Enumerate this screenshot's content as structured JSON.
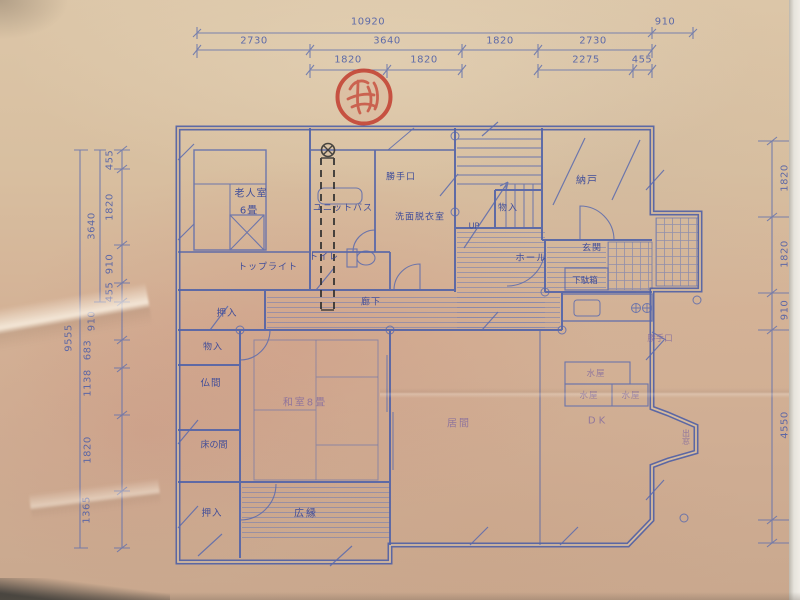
{
  "photo": {
    "description": "Photograph of a hand-drafted Japanese house floor plan (blueprint) with red seal stamp and pencil annotation"
  },
  "colors": {
    "paper": "#d5b59a",
    "ink_blue": "#4f5fa5",
    "label_blue": "#34459a",
    "stamp_red": "#c44536",
    "pencil_black": "#2e2e2e"
  },
  "stamp": {
    "kind": "red-hanko-seal"
  },
  "labels": {
    "roujin": "老人室",
    "roujin_size": "6畳",
    "toplight": "トップライト",
    "unitbath": "ユニットバス",
    "katteguchi_top": "勝手口",
    "senmen": "洗面脱衣室",
    "toilet": "トイレ",
    "monoire_stairs": "物入",
    "up": "UP",
    "nando": "納戸",
    "genkan": "玄関",
    "getabako": "下駄箱",
    "hall": "ホール",
    "rouka": "廊下",
    "oshiire_top": "押入",
    "monoire_left": "物入",
    "butsuma": "仏間",
    "tokonoma": "床の間",
    "oshiire_bottom": "押入",
    "washitsu": "和室8畳",
    "hiroen": "広縁",
    "ima": "居間",
    "dk": "DK",
    "mizuya_a": "水屋",
    "mizuya_b": "水屋",
    "mizuya_c": "水屋",
    "katteguchi_right": "勝手口",
    "demado": "出窓"
  },
  "dims": {
    "top": {
      "overall": "10920",
      "right": "910",
      "row1": [
        "2730",
        "3640",
        "1820",
        "2730"
      ],
      "row2": [
        "1820",
        "1820",
        "2275",
        "455"
      ]
    },
    "left": {
      "overall": "9555",
      "group": "3640",
      "chain": [
        "455",
        "1820",
        "910",
        "455",
        "910",
        "683",
        "1138",
        "1820",
        "1365"
      ]
    },
    "right": {
      "chain": [
        "1820",
        "1820",
        "910",
        "4550"
      ]
    }
  }
}
